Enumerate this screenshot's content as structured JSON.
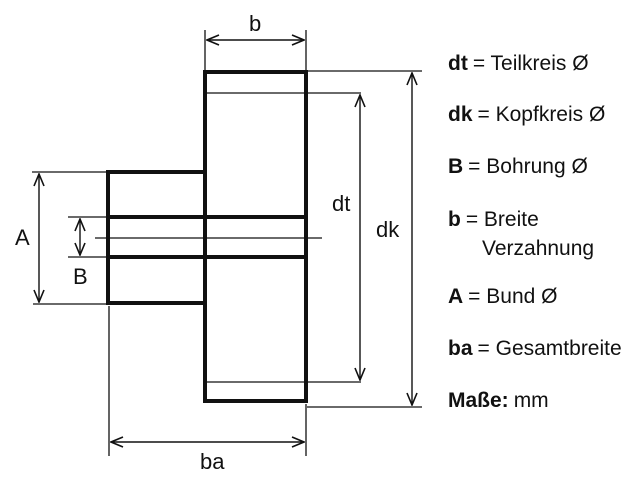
{
  "diagram": {
    "labels": {
      "b": "b",
      "A": "A",
      "B": "B",
      "dt": "dt",
      "dk": "dk",
      "ba": "ba"
    },
    "colors": {
      "ink": "#111111",
      "background": "#ffffff"
    }
  },
  "legend": {
    "rows": [
      {
        "key": "dt",
        "desc": "= Teilkreis Ø"
      },
      {
        "key": "dk",
        "desc": "= Kopfkreis Ø"
      },
      {
        "key": "B",
        "desc": "= Bohrung Ø"
      },
      {
        "key": "b",
        "desc": "= Breite"
      },
      {
        "key": "",
        "desc": "Verzahnung"
      },
      {
        "key": "A",
        "desc": "= Bund Ø"
      },
      {
        "key": "ba",
        "desc": "= Gesamtbreite"
      },
      {
        "key": "Maße:",
        "desc": "mm"
      }
    ]
  }
}
